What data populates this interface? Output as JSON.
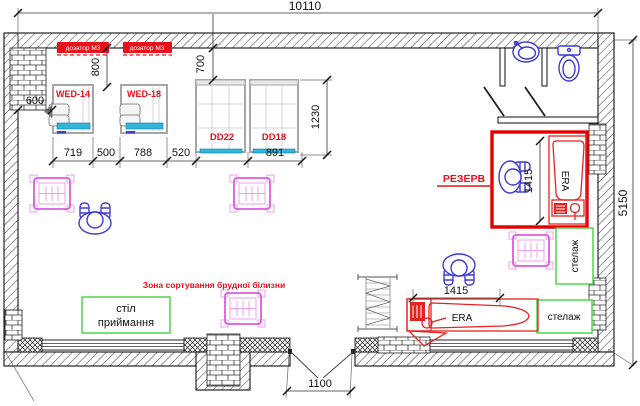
{
  "title": "Laundry room floor plan",
  "dimensions": {
    "overall_width": "10110",
    "overall_depth": "5150",
    "left_offset": "600",
    "washer_top_gap": "800",
    "dryer_top_gap": "700",
    "washer1_width": "719",
    "gap_washers": "500",
    "washer2_width": "788",
    "gap_dryer": "520",
    "dryer2_width": "891",
    "dryer_depth": "1230",
    "reserve_depth": "1415",
    "ironer_length": "1415",
    "door_opening": "1100"
  },
  "equipment": {
    "washer1": "WED-14",
    "washer2": "WED-18",
    "dryer1": "DD22",
    "dryer2": "DD18",
    "dispenser": "дозатор М3",
    "ironer": "ERA",
    "reserve": "РЕЗЕРВ"
  },
  "zones": {
    "sorting": "Зона сортування брудної білизни",
    "reception_line1": "стіл",
    "reception_line2": "приймання",
    "shelf": "стелаж"
  },
  "colors": {
    "dimension_text": "#111111",
    "equipment_label_red": "#e8111a",
    "reserve_outline": "#e60000",
    "furniture_green": "#41d341",
    "cart_magenta": "#da5cdc",
    "fixture_blue": "#3b3bd0",
    "panel_cyan": "#2fb6d9",
    "machine_gray": "#a6a6a6"
  }
}
